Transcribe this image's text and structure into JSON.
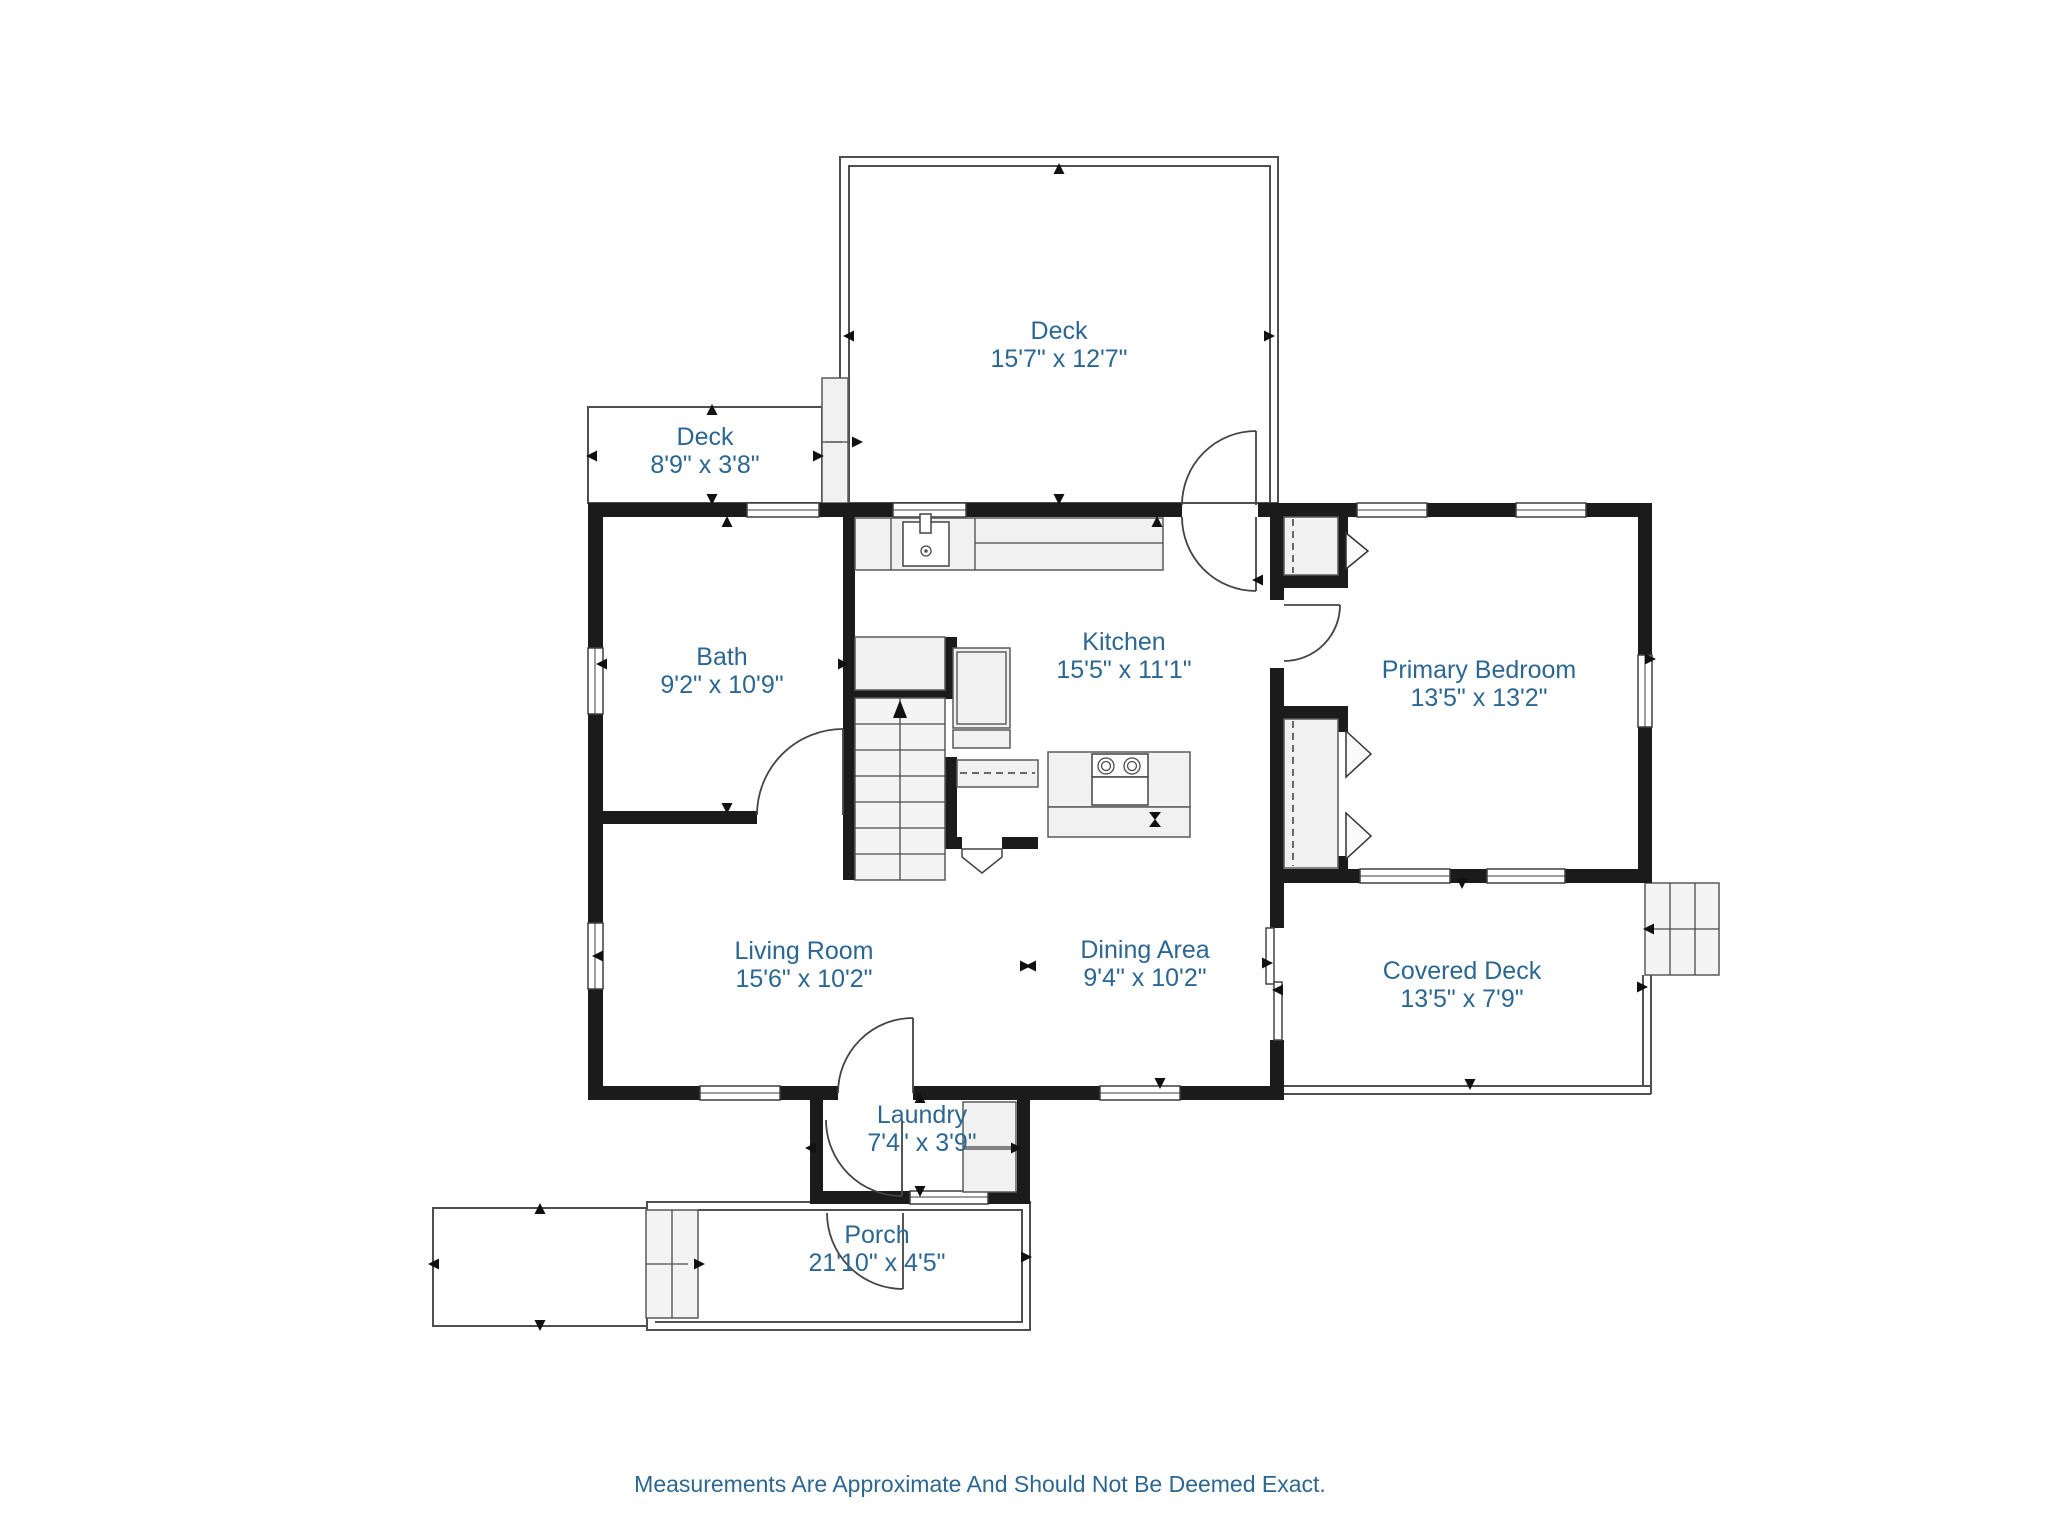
{
  "footer": {
    "disclaimer": "Measurements Are Approximate And Should Not Be Deemed Exact."
  },
  "colors": {
    "label_text": "#2c6791",
    "wall": "#1b1b1b",
    "thin_line": "#4f4f4f",
    "light_fill": "#f1f1f1"
  },
  "rooms": [
    {
      "id": "deck-upper",
      "name": "Deck",
      "dims": "15'7\" x 12'7\""
    },
    {
      "id": "deck-side",
      "name": "Deck",
      "dims": "8'9\" x 3'8\""
    },
    {
      "id": "bath",
      "name": "Bath",
      "dims": "9'2\" x 10'9\""
    },
    {
      "id": "kitchen",
      "name": "Kitchen",
      "dims": "15'5\" x 11'1\""
    },
    {
      "id": "primary-bedroom",
      "name": "Primary Bedroom",
      "dims": "13'5\" x 13'2\""
    },
    {
      "id": "living-room",
      "name": "Living Room",
      "dims": "15'6\" x 10'2\""
    },
    {
      "id": "dining-area",
      "name": "Dining Area",
      "dims": "9'4\" x 10'2\""
    },
    {
      "id": "covered-deck",
      "name": "Covered Deck",
      "dims": "13'5\" x 7'9\""
    },
    {
      "id": "laundry",
      "name": "Laundry",
      "dims": "7'4\" x 3'9\""
    },
    {
      "id": "porch",
      "name": "Porch",
      "dims": "21'10\" x 4'5\""
    }
  ]
}
